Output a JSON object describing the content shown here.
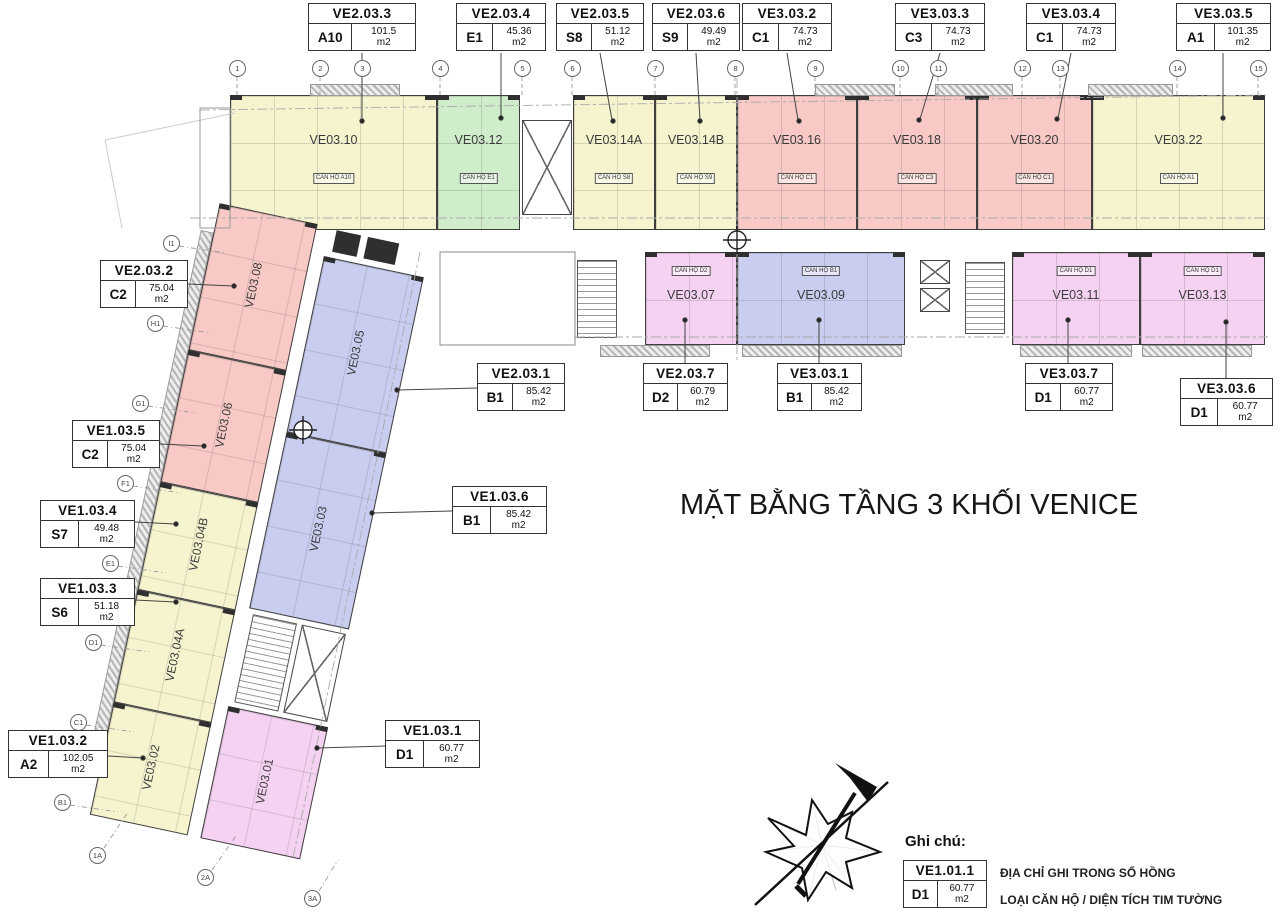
{
  "title": "MẶT BẰNG TẦNG 3 KHỐI VENICE",
  "strings": {
    "m2": "m2"
  },
  "colors": {
    "yellow": "#f6f3cf",
    "green": "#cfeccb",
    "salmon": "#f8c9c5",
    "pink": "#f6d2f2",
    "blue": "#c9cdf0",
    "line": "#3e3e3e"
  },
  "legend": {
    "heading": "Ghi chú:",
    "sample_code": "VE1.01.1",
    "sample_type": "D1",
    "sample_area": "60.77",
    "line1": "ĐỊA CHỈ GHI TRONG SỔ HỒNG",
    "line2": "LOẠI CĂN HỘ / DIỆN TÍCH TIM TƯỜNG"
  },
  "callouts": [
    {
      "code": "VE2.03.3",
      "type": "A10",
      "area": "101.5"
    },
    {
      "code": "VE2.03.4",
      "type": "E1",
      "area": "45.36"
    },
    {
      "code": "VE2.03.5",
      "type": "S8",
      "area": "51.12"
    },
    {
      "code": "VE2.03.6",
      "type": "S9",
      "area": "49.49"
    },
    {
      "code": "VE3.03.2",
      "type": "C1",
      "area": "74.73"
    },
    {
      "code": "VE3.03.3",
      "type": "C3",
      "area": "74.73"
    },
    {
      "code": "VE3.03.4",
      "type": "C1",
      "area": "74.73"
    },
    {
      "code": "VE3.03.5",
      "type": "A1",
      "area": "101.35"
    },
    {
      "code": "VE2.03.2",
      "type": "C2",
      "area": "75.04"
    },
    {
      "code": "VE1.03.5",
      "type": "C2",
      "area": "75.04"
    },
    {
      "code": "VE1.03.4",
      "type": "S7",
      "area": "49.48"
    },
    {
      "code": "VE1.03.3",
      "type": "S6",
      "area": "51.18"
    },
    {
      "code": "VE1.03.2",
      "type": "A2",
      "area": "102.05"
    },
    {
      "code": "VE1.03.1",
      "type": "D1",
      "area": "60.77"
    },
    {
      "code": "VE1.03.6",
      "type": "B1",
      "area": "85.42"
    },
    {
      "code": "VE2.03.1",
      "type": "B1",
      "area": "85.42"
    },
    {
      "code": "VE2.03.7",
      "type": "D2",
      "area": "60.79"
    },
    {
      "code": "VE3.03.1",
      "type": "B1",
      "area": "85.42"
    },
    {
      "code": "VE3.03.7",
      "type": "D1",
      "area": "60.77"
    },
    {
      "code": "VE3.03.6",
      "type": "D1",
      "area": "60.77"
    }
  ],
  "units": [
    {
      "name": "VE03.10",
      "tag": "CĂN HỘ A10"
    },
    {
      "name": "VE03.12",
      "tag": "CĂN HỘ E1"
    },
    {
      "name": "VE03.14A",
      "tag": "CĂN HỘ S8"
    },
    {
      "name": "VE03.14B",
      "tag": "CĂN HỘ S9"
    },
    {
      "name": "VE03.16",
      "tag": "CĂN HỘ C1"
    },
    {
      "name": "VE03.18",
      "tag": "CĂN HỘ C3"
    },
    {
      "name": "VE03.20",
      "tag": "CĂN HỘ C1"
    },
    {
      "name": "VE03.22",
      "tag": "CĂN HỘ A1"
    },
    {
      "name": "VE03.07",
      "tag": "CĂN HỘ D2"
    },
    {
      "name": "VE03.09",
      "tag": "CĂN HỘ B1"
    },
    {
      "name": "VE03.11",
      "tag": "CĂN HỘ D1"
    },
    {
      "name": "VE03.13",
      "tag": "CĂN HỘ D1"
    },
    {
      "name": "VE03.08"
    },
    {
      "name": "VE03.06"
    },
    {
      "name": "VE03.04B"
    },
    {
      "name": "VE03.04A"
    },
    {
      "name": "VE03.02"
    },
    {
      "name": "VE03.05"
    },
    {
      "name": "VE03.03"
    },
    {
      "name": "VE03.01"
    }
  ],
  "grid": {
    "top": [
      "1",
      "2",
      "3",
      "4",
      "5",
      "6",
      "7",
      "8",
      "9",
      "10",
      "11",
      "12",
      "13",
      "14",
      "15"
    ],
    "left": [
      "I1",
      "H1",
      "G1",
      "F1",
      "E1",
      "D1",
      "C1",
      "B1"
    ],
    "bottom": [
      "1A",
      "2A",
      "3A"
    ]
  }
}
